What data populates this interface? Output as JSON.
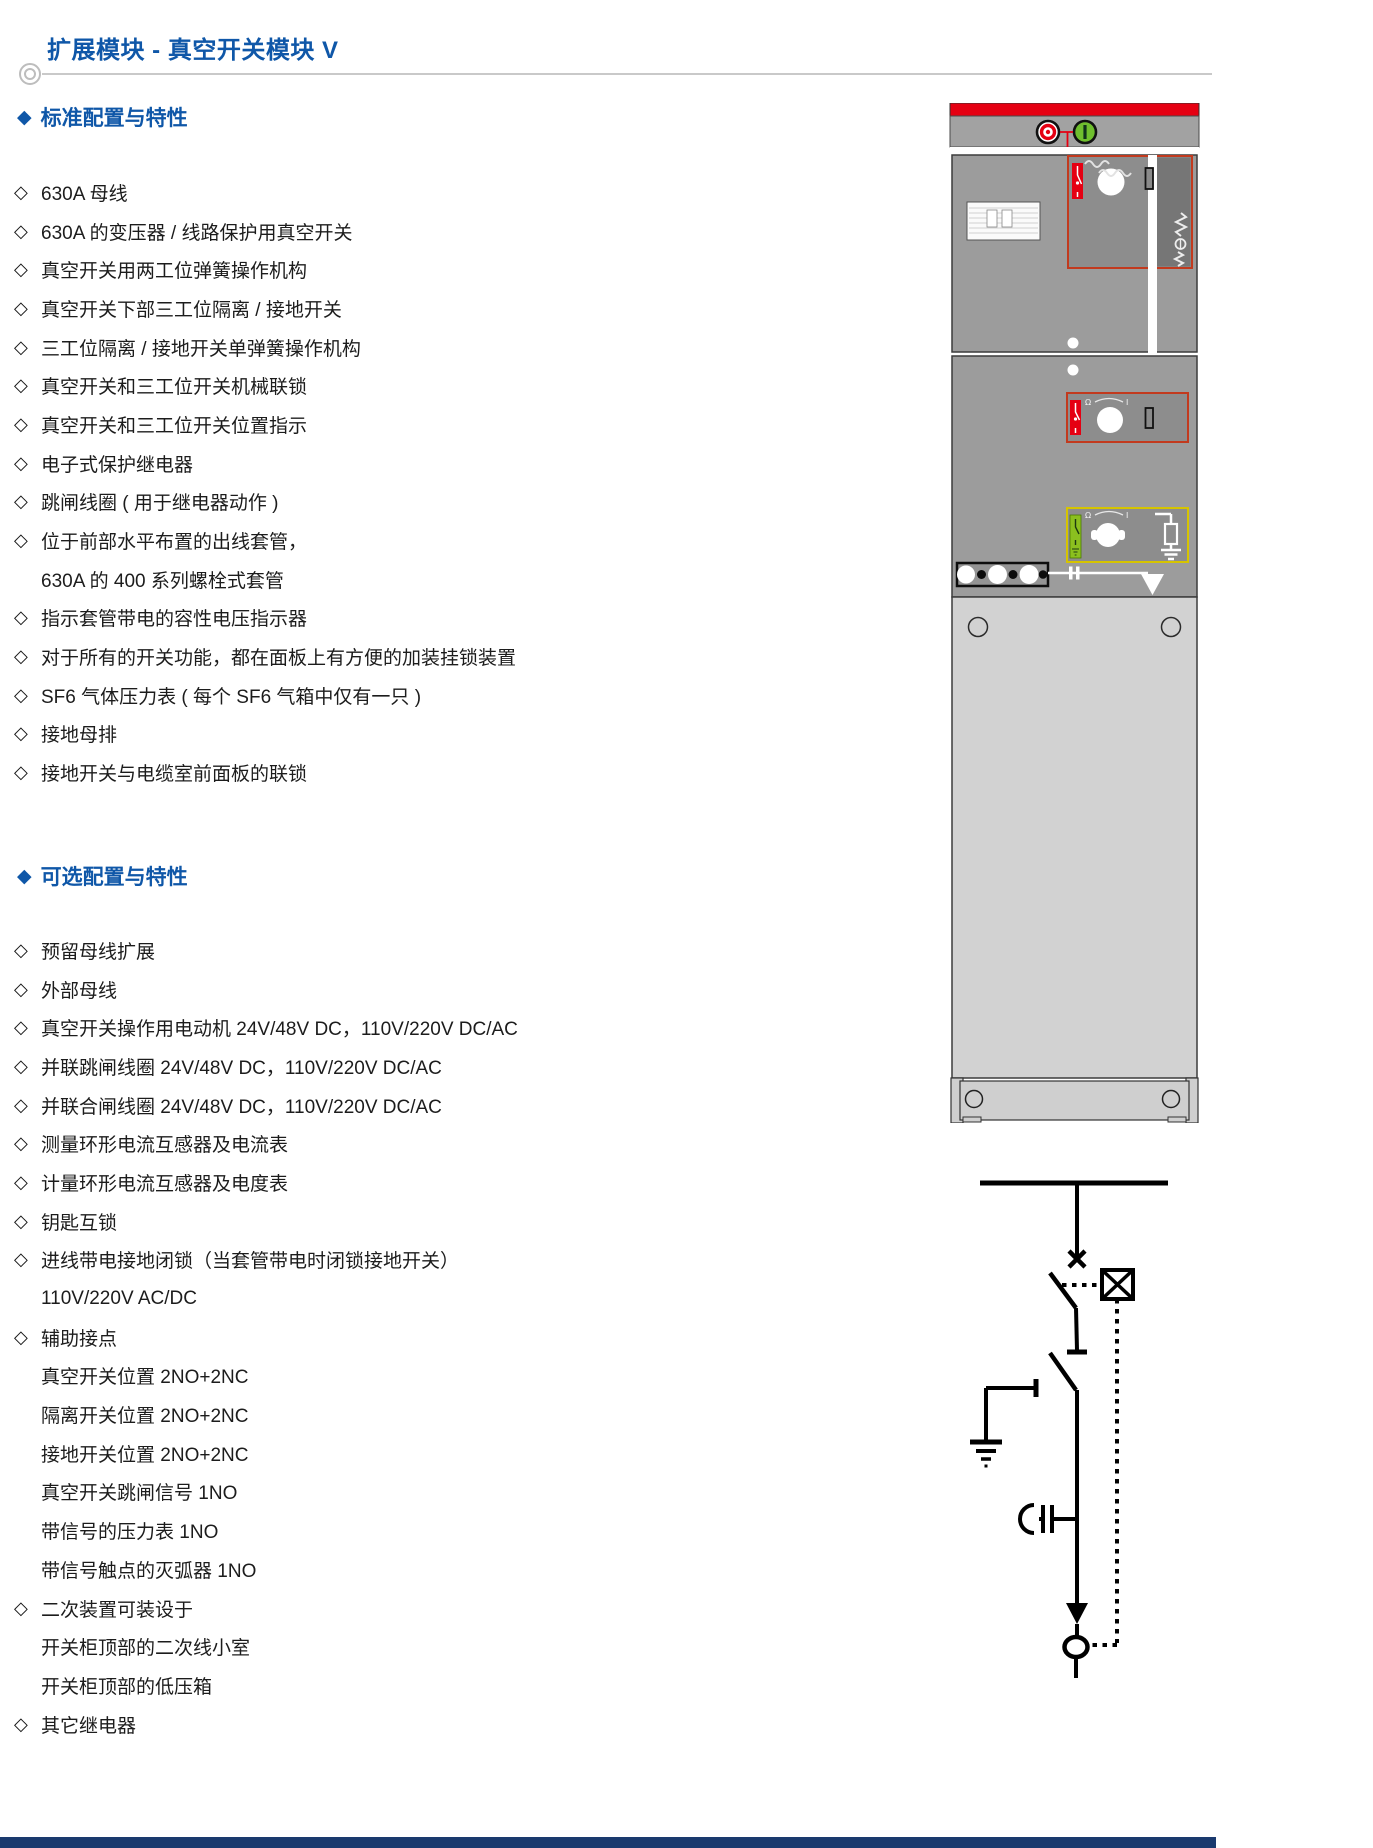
{
  "page": {
    "title": "扩展模块 - 真空开关模块 V"
  },
  "bullets": {
    "item": "◇",
    "section": "◆"
  },
  "sections": [
    {
      "heading": "标准配置与特性",
      "items": [
        {
          "t": "630A 母线"
        },
        {
          "t": "630A 的变压器 / 线路保护用真空开关"
        },
        {
          "t": "真空开关用两工位弹簧操作机构"
        },
        {
          "t": "真空开关下部三工位隔离 / 接地开关"
        },
        {
          "t": "三工位隔离 / 接地开关单弹簧操作机构"
        },
        {
          "t": "真空开关和三工位开关机械联锁"
        },
        {
          "t": "真空开关和三工位开关位置指示"
        },
        {
          "t": "电子式保护继电器"
        },
        {
          "t": "跳闸线圈 ( 用于继电器动作 )"
        },
        {
          "t": "位于前部水平布置的出线套管，"
        },
        {
          "t": "630A 的 400 系列螺栓式套管",
          "ind": true
        },
        {
          "t": "指示套管带电的容性电压指示器"
        },
        {
          "t": "对于所有的开关功能，都在面板上有方便的加装挂锁装置"
        },
        {
          "t": "SF6 气体压力表 ( 每个 SF6 气箱中仅有一只 )"
        },
        {
          "t": "接地母排"
        },
        {
          "t": "接地开关与电缆室前面板的联锁"
        }
      ]
    },
    {
      "heading": "可选配置与特性",
      "items": [
        {
          "t": "预留母线扩展"
        },
        {
          "t": "外部母线"
        },
        {
          "t": "真空开关操作用电动机 24V/48V DC，110V/220V DC/AC"
        },
        {
          "t": "并联跳闸线圈 24V/48V DC，110V/220V DC/AC"
        },
        {
          "t": "并联合闸线圈 24V/48V DC，110V/220V DC/AC"
        },
        {
          "t": "测量环形电流互感器及电流表"
        },
        {
          "t": "计量环形电流互感器及电度表"
        },
        {
          "t": "钥匙互锁"
        },
        {
          "t": "进线带电接地闭锁（当套管带电时闭锁接地开关）"
        },
        {
          "t": "110V/220V AC/DC",
          "ind": true
        },
        {
          "t": "辅助接点"
        },
        {
          "t": "真空开关位置 2NO+2NC",
          "ind": true
        },
        {
          "t": "隔离开关位置 2NO+2NC",
          "ind": true
        },
        {
          "t": "接地开关位置 2NO+2NC",
          "ind": true
        },
        {
          "t": "真空开关跳闸信号 1NO",
          "ind": true
        },
        {
          "t": "带信号的压力表 1NO",
          "ind": true
        },
        {
          "t": "带信号触点的灭弧器 1NO",
          "ind": true
        },
        {
          "t": "二次装置可装设于"
        },
        {
          "t": "开关柜顶部的二次线小室",
          "ind": true
        },
        {
          "t": "开关柜顶部的低压箱",
          "ind": true
        },
        {
          "t": "其它继电器"
        }
      ]
    }
  ],
  "figure": {
    "cabinet_parts": [
      "red-top-bar",
      "off-button",
      "on-button",
      "nameplate",
      "vacuum-switch-operating-panel",
      "three-position-switch-panel",
      "earthing-operating-panel",
      "spring-mechanism-symbol",
      "cable-bushing-bar",
      "busbar-stripe",
      "cable-compartment-door",
      "base-plinth"
    ],
    "panel_labels": {
      "rotation_left": "Ω",
      "rotation_right": "I"
    },
    "diagram_parts": [
      "busbar-line",
      "disconnector-x",
      "three-position-switch-blade",
      "mechanism-interlock-box",
      "vacuum-breaker-blade",
      "earthing-switch-branch",
      "ground-symbol",
      "capacitive-voltage-indicator",
      "cable-arrow",
      "cable-termination-circle",
      "interlock-dotted-line"
    ]
  },
  "colors": {
    "accent": "#0f57a8",
    "red": "#e50012",
    "panel_outline": "#c23a1e",
    "yellow_outline": "#d6c400",
    "green": "#8bc01f",
    "cabinet_gray": "#9c9c9c",
    "cabinet_light": "#d2d2d2",
    "navy": "#1a3a6e"
  }
}
